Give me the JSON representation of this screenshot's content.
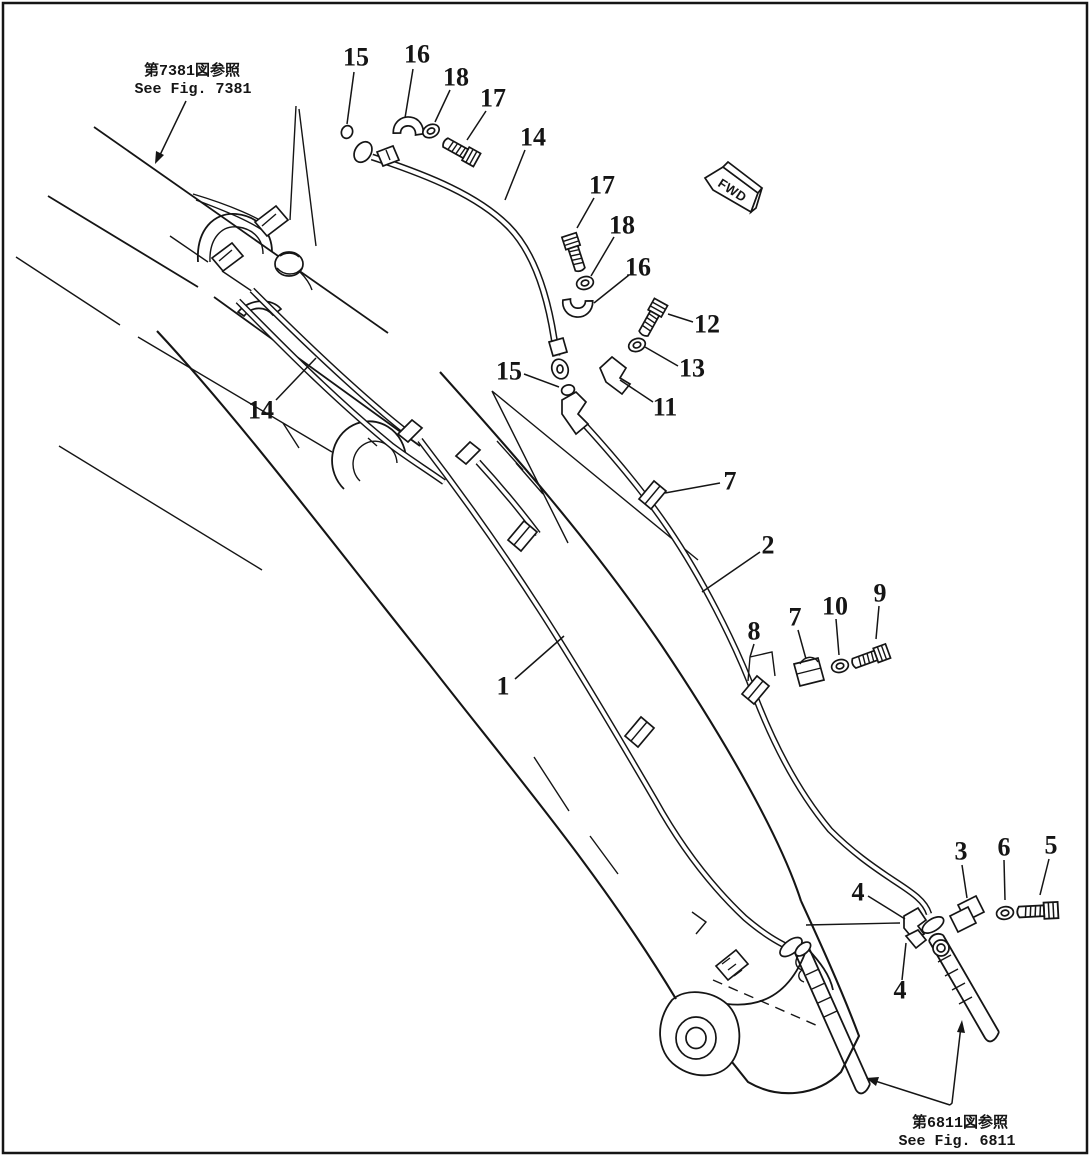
{
  "diagram": {
    "ink_color": "#151515",
    "background": "#ffffff",
    "references": {
      "fig7381": {
        "jp": "第7381図参照",
        "en": "See Fig. 7381"
      },
      "fig6811": {
        "jp": "第6811図参照",
        "en": "See Fig. 6811"
      }
    },
    "direction_flag": {
      "label": "FWD"
    },
    "callouts": [
      {
        "label": "15",
        "x": 356,
        "y": 57,
        "leader": [
          354,
          72,
          347,
          124
        ]
      },
      {
        "label": "16",
        "x": 417,
        "y": 54,
        "leader": [
          413,
          69,
          405,
          118
        ]
      },
      {
        "label": "18",
        "x": 456,
        "y": 77,
        "leader": [
          450,
          90,
          435,
          122
        ]
      },
      {
        "label": "17",
        "x": 493,
        "y": 98,
        "leader": [
          486,
          111,
          467,
          140
        ]
      },
      {
        "label": "14",
        "x": 533,
        "y": 137,
        "leader": [
          525,
          150,
          505,
          200
        ]
      },
      {
        "label": "17",
        "x": 602,
        "y": 185,
        "leader": [
          594,
          198,
          577,
          228
        ]
      },
      {
        "label": "18",
        "x": 622,
        "y": 225,
        "leader": [
          614,
          237,
          591,
          276
        ]
      },
      {
        "label": "16",
        "x": 638,
        "y": 267,
        "leader": [
          629,
          275,
          594,
          303
        ]
      },
      {
        "label": "12",
        "x": 707,
        "y": 324,
        "leader": [
          693,
          322,
          668,
          314
        ]
      },
      {
        "label": "13",
        "x": 692,
        "y": 368,
        "leader": [
          678,
          366,
          645,
          347
        ]
      },
      {
        "label": "11",
        "x": 665,
        "y": 407,
        "leader": [
          653,
          402,
          620,
          380
        ]
      },
      {
        "label": "15",
        "x": 509,
        "y": 371,
        "leader": [
          524,
          374,
          559,
          387
        ]
      },
      {
        "label": "14",
        "x": 261,
        "y": 410,
        "leader": [
          276,
          400,
          316,
          358
        ]
      },
      {
        "label": "7",
        "x": 730,
        "y": 481,
        "leader": [
          720,
          483,
          665,
          493
        ]
      },
      {
        "label": "2",
        "x": 768,
        "y": 545,
        "leader": [
          760,
          552,
          702,
          592
        ]
      },
      {
        "label": "1",
        "x": 503,
        "y": 686,
        "leader": [
          515,
          679,
          564,
          636
        ]
      },
      {
        "label": "8",
        "x": 754,
        "y": 631,
        "leader": [
          754,
          644,
          750,
          657
        ]
      },
      {
        "label": "7",
        "x": 795,
        "y": 617,
        "leader": [
          798,
          630,
          806,
          659
        ]
      },
      {
        "label": "10",
        "x": 835,
        "y": 606,
        "leader": [
          836,
          619,
          839,
          655
        ]
      },
      {
        "label": "9",
        "x": 880,
        "y": 593,
        "leader": [
          879,
          606,
          876,
          639
        ]
      },
      {
        "label": "3",
        "x": 961,
        "y": 851,
        "leader": [
          962,
          865,
          967,
          898
        ]
      },
      {
        "label": "6",
        "x": 1004,
        "y": 847,
        "leader": [
          1004,
          860,
          1005,
          900
        ]
      },
      {
        "label": "5",
        "x": 1051,
        "y": 845,
        "leader": [
          1049,
          859,
          1040,
          895
        ]
      },
      {
        "label": "4",
        "x": 858,
        "y": 892,
        "leader": [
          868,
          896,
          905,
          919
        ]
      },
      {
        "label": "4",
        "x": 900,
        "y": 990,
        "leader": [
          902,
          980,
          906,
          943
        ]
      }
    ]
  }
}
